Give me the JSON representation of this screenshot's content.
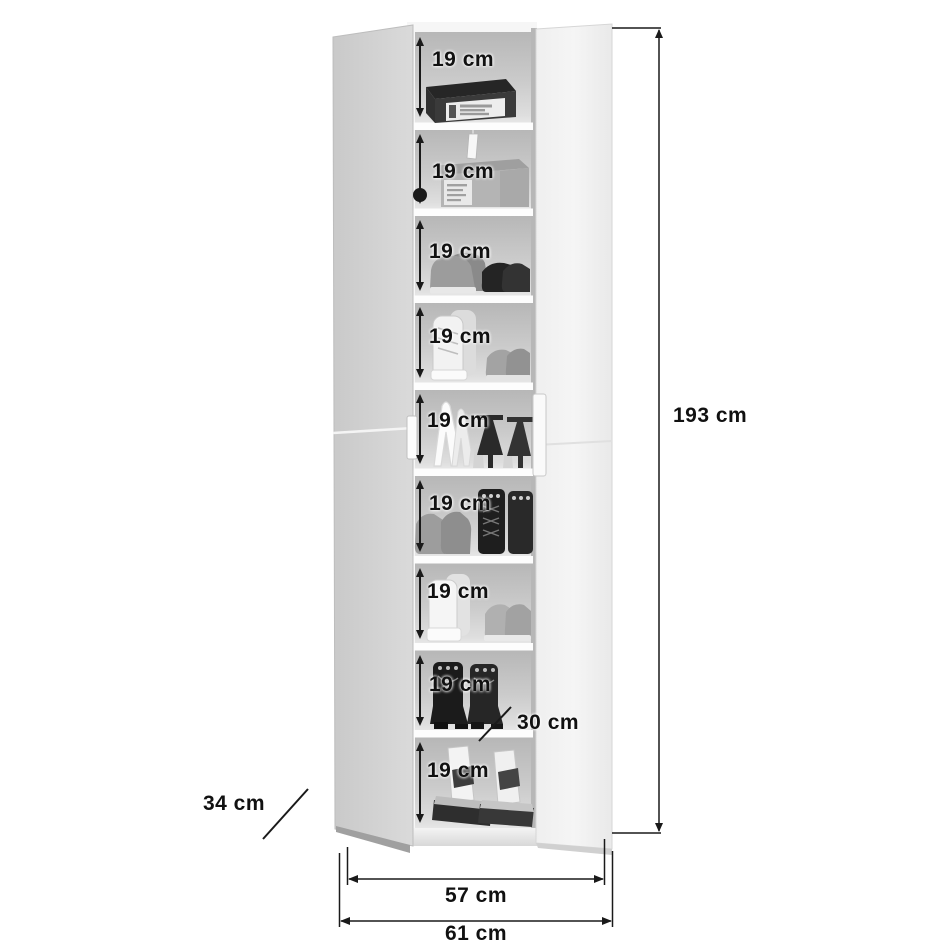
{
  "diagram": {
    "subject": "shoe-cabinet-dimension-drawing",
    "unit": "cm",
    "overall": {
      "height": {
        "label": "193 cm",
        "value": 193
      },
      "front_width": {
        "label": "57 cm",
        "value": 57
      },
      "total_width": {
        "label": "61 cm",
        "value": 61
      },
      "depth": {
        "label": "34 cm",
        "value": 34
      },
      "shelf_depth": {
        "label": "30 cm",
        "value": 30
      }
    },
    "compartments": [
      {
        "label": "19 cm",
        "value": 19,
        "content": "black-shoe-box"
      },
      {
        "label": "19 cm",
        "value": 19,
        "content": "grey-shoe-box-with-tag"
      },
      {
        "label": "19 cm",
        "value": 19,
        "content": "sneakers-and-loafers"
      },
      {
        "label": "19 cm",
        "value": 19,
        "content": "high-top-sneakers-and-slip-ons"
      },
      {
        "label": "19 cm",
        "value": 19,
        "content": "high-heel-pumps"
      },
      {
        "label": "19 cm",
        "value": 19,
        "content": "suede-shoes-and-lace-up-boots"
      },
      {
        "label": "19 cm",
        "value": 19,
        "content": "wedge-sneaker-and-trainers"
      },
      {
        "label": "19 cm",
        "value": 19,
        "content": "heeled-ankle-boots"
      },
      {
        "label": "19 cm",
        "value": 19,
        "content": "platform-sandals"
      }
    ],
    "palette": {
      "line": "#1a1a1a",
      "interior_back": "#c7c7c7",
      "left_door": "#d2d2d2",
      "right_door": "#f3f3f3",
      "shelf_board": "#fdfdfd",
      "background": "#ffffff"
    }
  }
}
